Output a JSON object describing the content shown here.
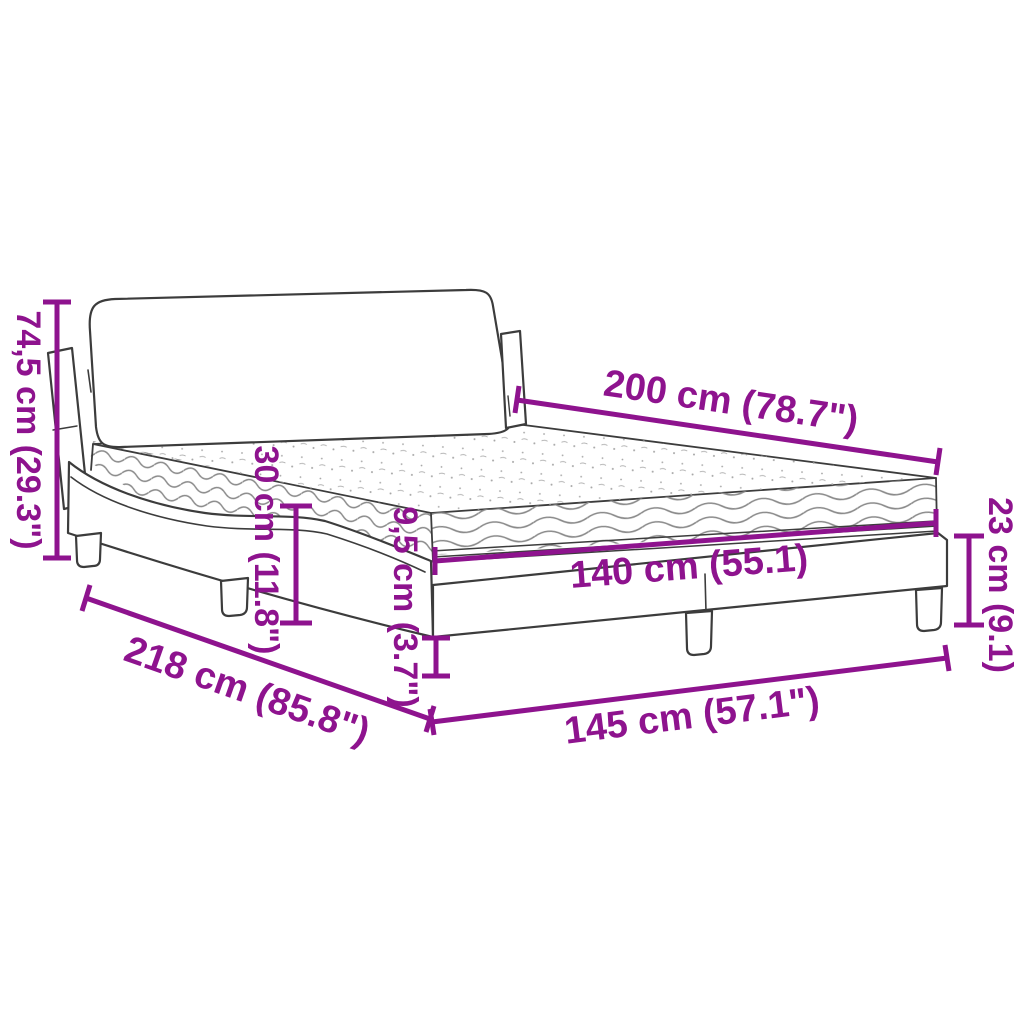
{
  "diagram": {
    "subject": "bed-with-mattress-dimension-diagram",
    "dimensions": {
      "headboard_height": "74,5 cm (29.3\")",
      "mattress_length": "200 cm (78.7\")",
      "mattress_side_height": "30 cm (11.8\")",
      "front_corner_rail_height": "9,5 cm (3.7\")",
      "mattress_width": "140 cm (55.1)",
      "frame_end_height": "23 cm (9.1)",
      "total_length": "218 cm (85.8\")",
      "total_width": "145 cm (57.1\")"
    },
    "colors": {
      "dimension_accent": "#8E138E",
      "line_art": "#3C3C3C",
      "wave_texture": "#8A8A8A",
      "stipple_texture": "#A6A6A6",
      "background": "#FFFFFF"
    }
  }
}
